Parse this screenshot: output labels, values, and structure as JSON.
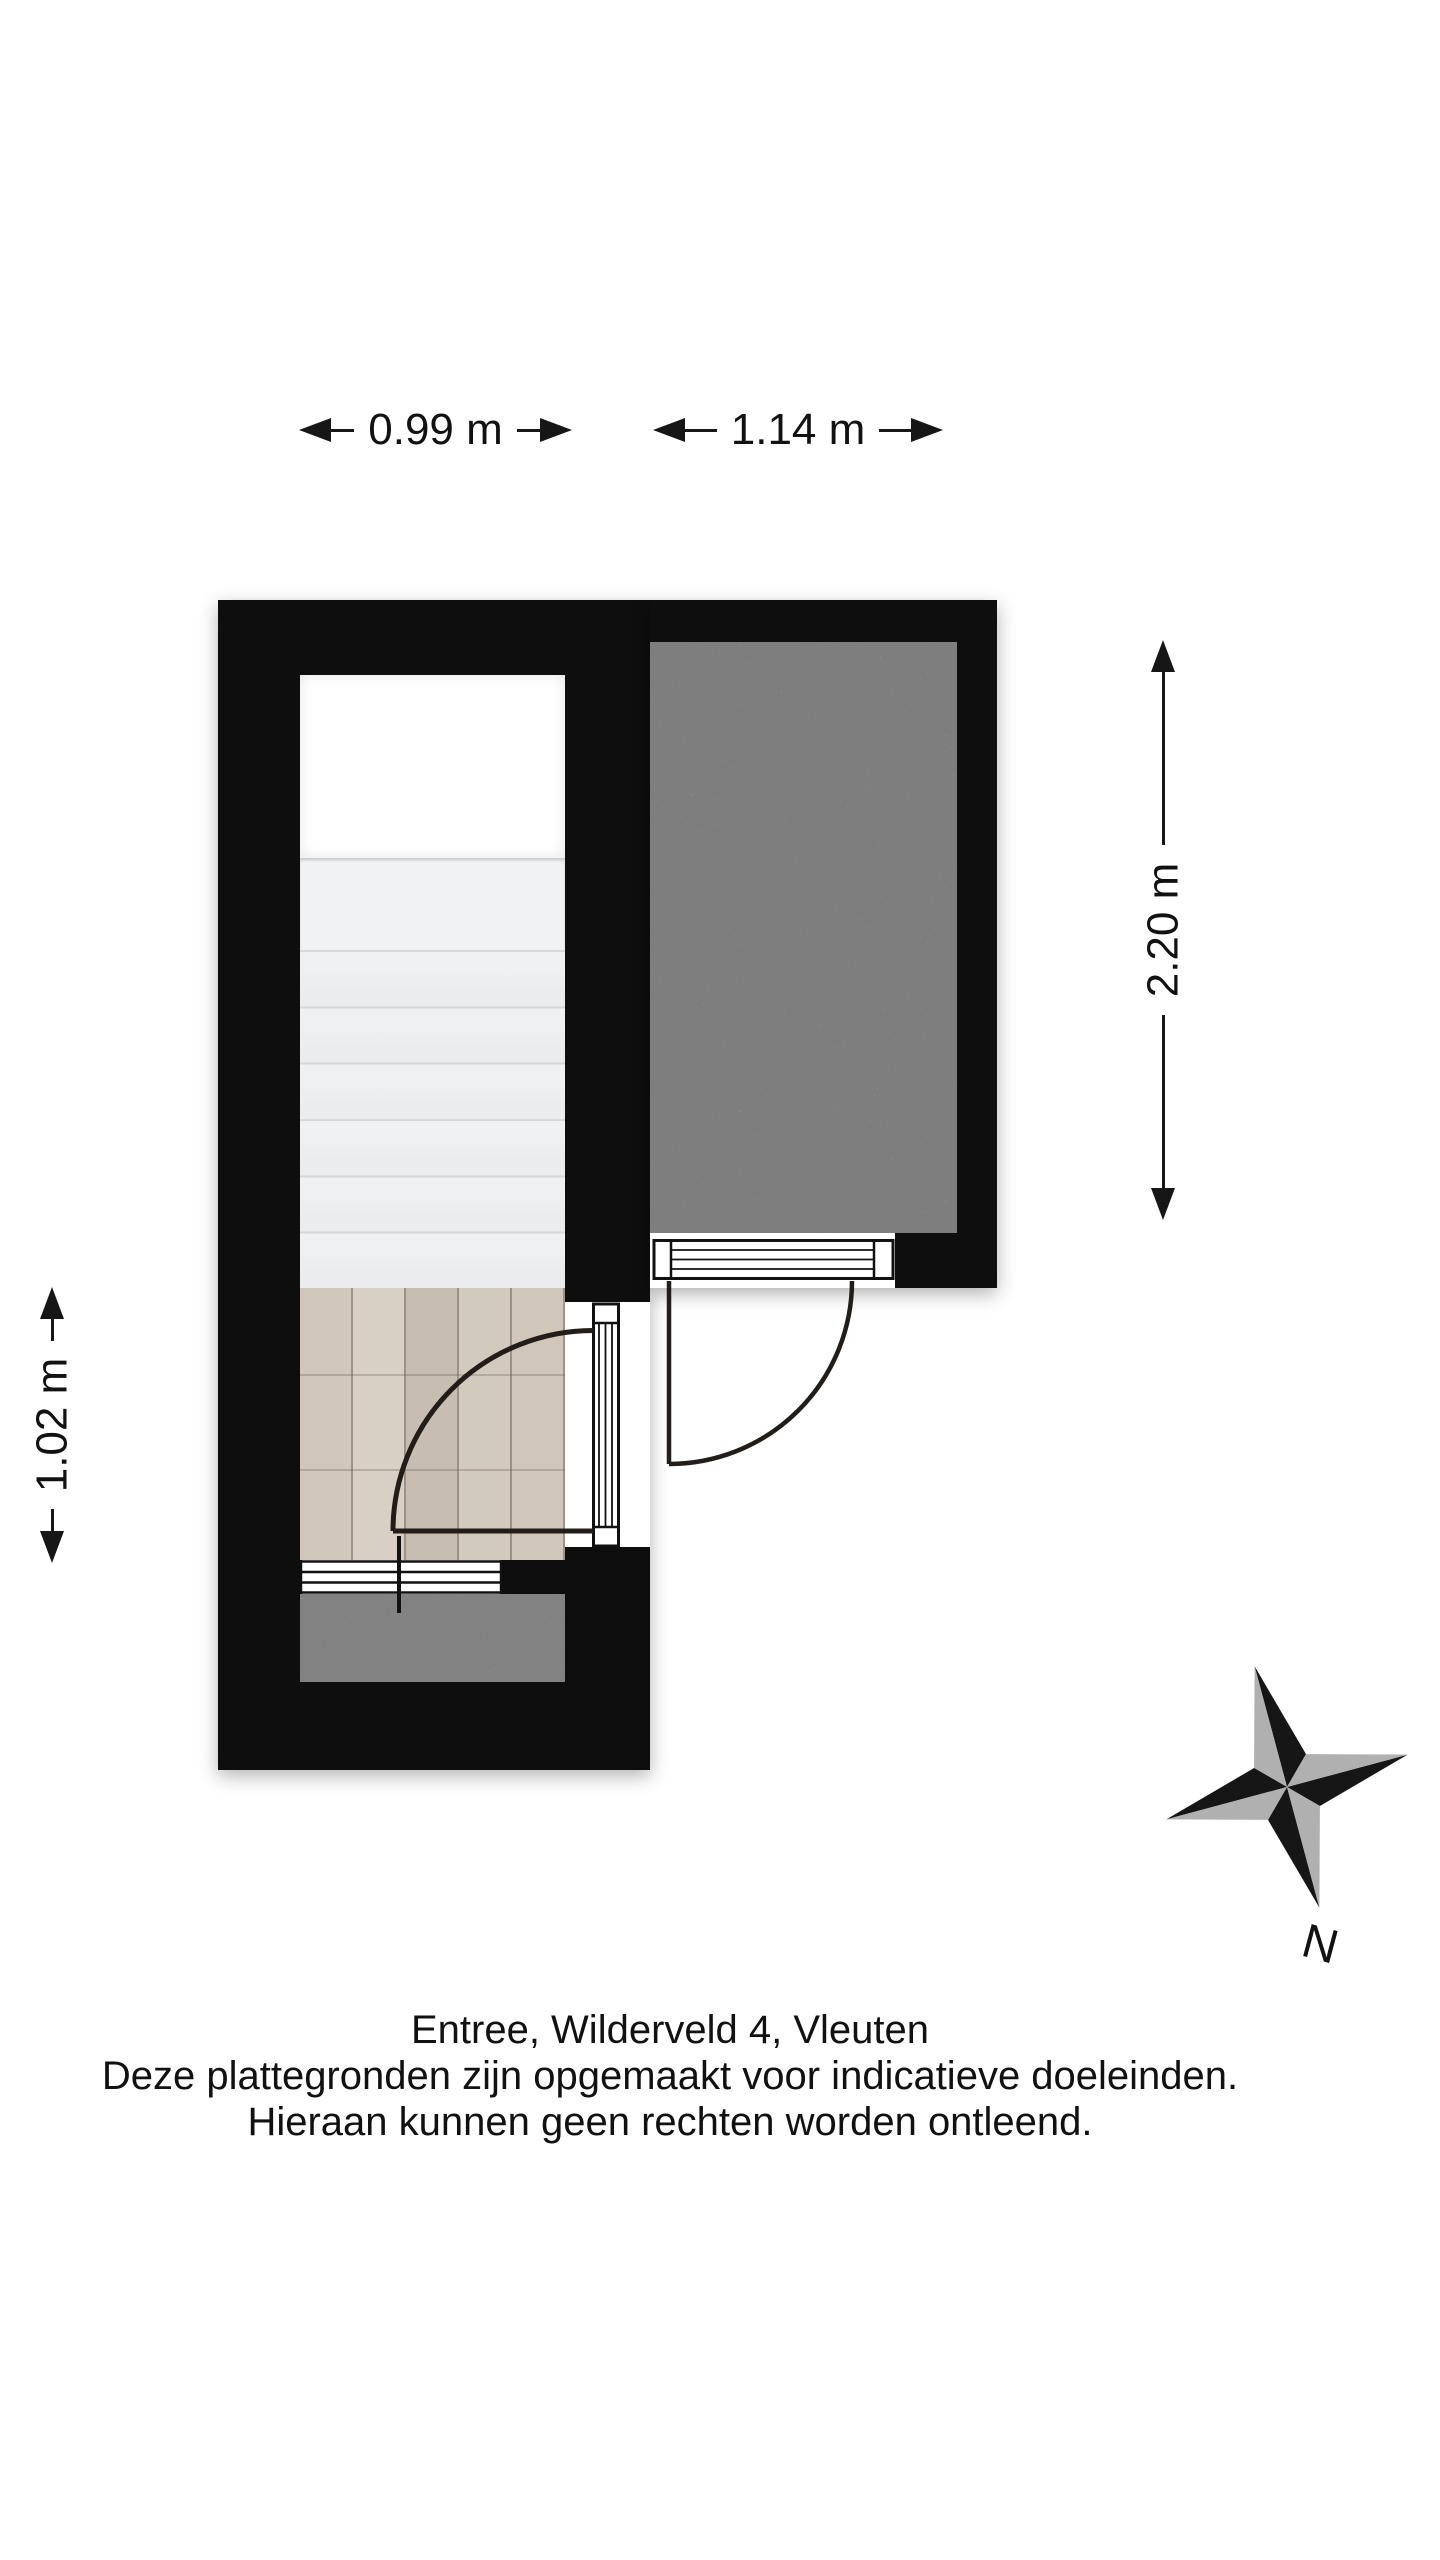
{
  "plan": {
    "address": "Entree, Wilderveld 4, Vleuten",
    "rooms": [
      {
        "name": "trap (stairs)",
        "floor": "stair treads"
      },
      {
        "name": "entree",
        "floor": "wood planks"
      },
      {
        "name": "berging (storage room)",
        "floor": "gray concrete"
      },
      {
        "name": "entree-portaal (porch)",
        "floor": "gray concrete"
      }
    ]
  },
  "dims": {
    "stair_width": "0.99 m",
    "storage_width": "1.14 m",
    "storage_height": "2.20 m",
    "entree_height": "1.02 m"
  },
  "compass": {
    "north": "N"
  },
  "footer": {
    "line1": "Entree, Wilderveld 4, Vleuten",
    "line2": "Deze plattegronden zijn opgemaakt voor indicatieve doeleinden.",
    "line3": "Hieraan kunnen geen rechten worden ontleend."
  },
  "colors": {
    "wall": "#0e0e0e",
    "wood_floor": "#d0c6ba",
    "storage_floor": "#b0b0b0",
    "porch_floor": "#b6b6b6",
    "stair_tread": "#eef0f1",
    "compass_gray": "#b0b0b0",
    "text": "#111111"
  }
}
